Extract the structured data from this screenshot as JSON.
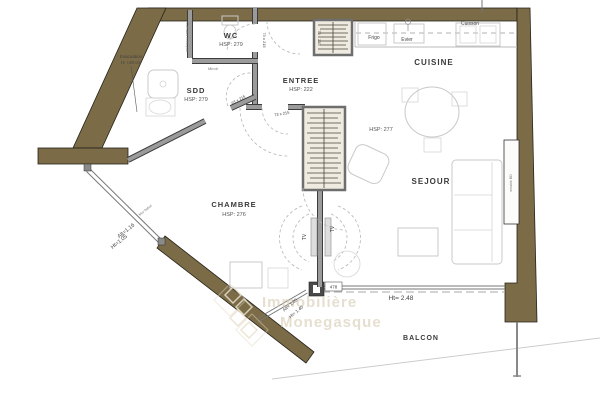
{
  "rooms": {
    "wc": {
      "name": "WC",
      "hsp": "HSP: 279"
    },
    "sdd": {
      "name": "SDD",
      "hsp": "HSP: 279"
    },
    "entree": {
      "name": "ENTREE",
      "hsp": "HSP: 222"
    },
    "cuisine": {
      "name": "CUISINE",
      "hsp": "HSP: 277"
    },
    "sejour": {
      "name": "SEJOUR"
    },
    "chambre": {
      "name": "CHAMBRE",
      "hsp": "HSP: 276"
    },
    "balcon": {
      "name": "BALCON"
    }
  },
  "kitchen": {
    "frigo": "Frigo",
    "evier": "Evier",
    "cuisson": "Cuisson"
  },
  "doors": {
    "entry": "73 x 215",
    "wc": "73 x 215",
    "chambre": "73 x 215",
    "sdd": "63 x 215"
  },
  "windows": {
    "bay_width": "478",
    "bay_height": "Ht= 2.48",
    "chambre_window_alt": "Alt=1.16",
    "chambre_window_ht": "Ht=1.05",
    "balcony_window_alt": "Alt= 1.05",
    "balcony_window_ht": "Ht= 1.40",
    "mur_bahut": "Mur bahut"
  },
  "annotations": {
    "evacuation_1": "Evacuation",
    "evacuation_2": "H: +20 cm",
    "miroir": "Miroir",
    "cumulus": "Cumulus extra-plat",
    "meuble": "meuble BD",
    "tv_left": "TV",
    "tv_right": "TV"
  },
  "watermark": {
    "line1": "Immobilière",
    "line2": "Monegasque"
  },
  "colors": {
    "wall": "#7b6b46",
    "partition": "#9b9b9b",
    "furniture": "#c9c9c9",
    "watermark": "#d6cab0"
  }
}
